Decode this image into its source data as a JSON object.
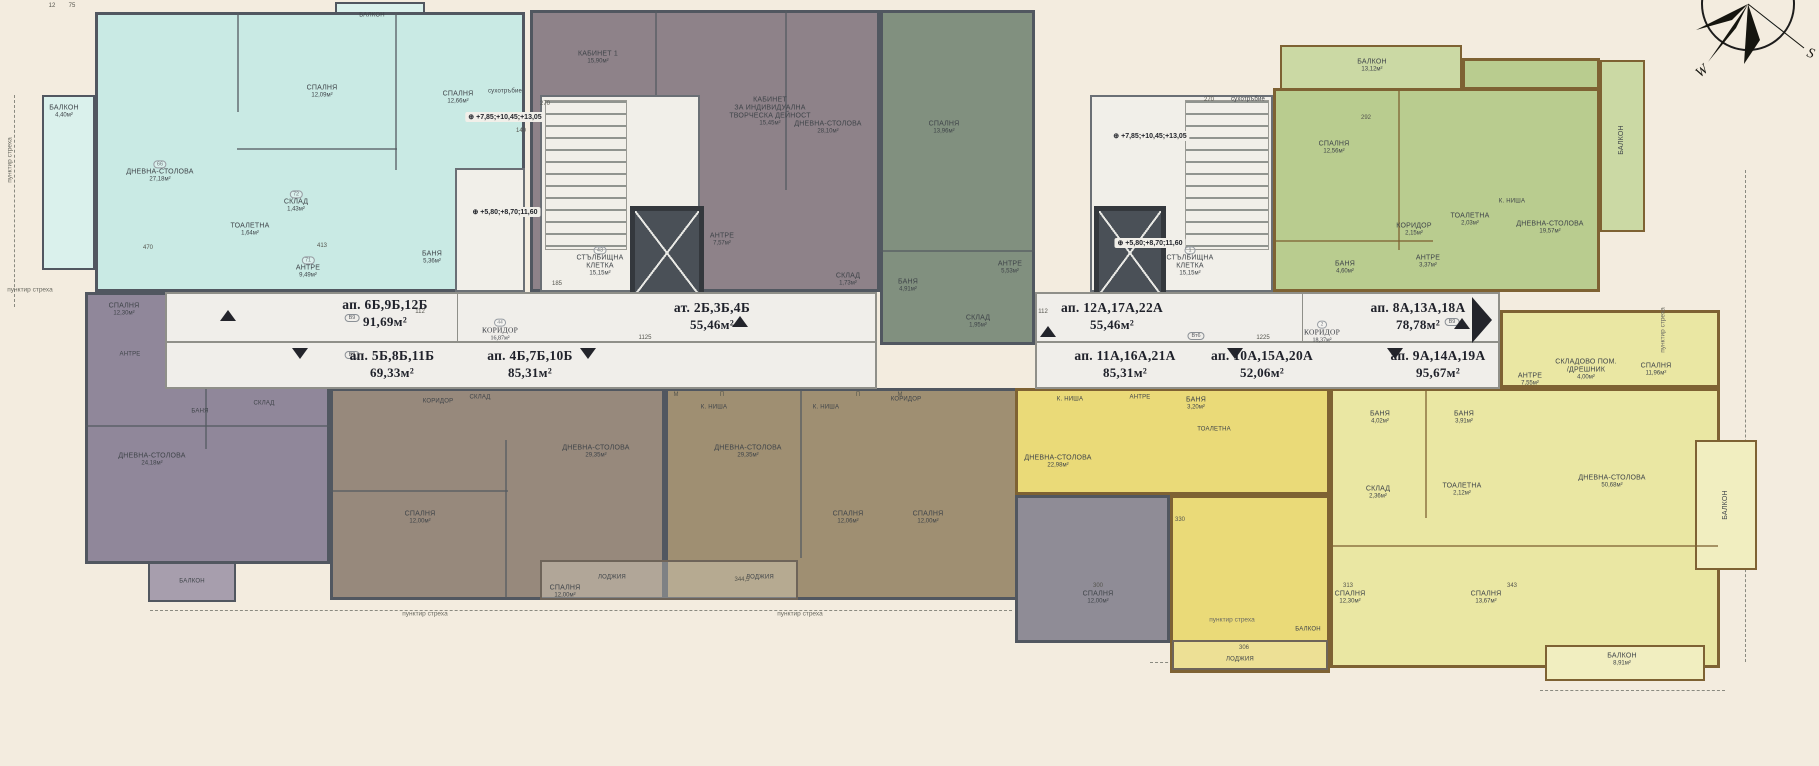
{
  "palette": {
    "background": "#f3ecdf",
    "teal": "#c9eae4",
    "purple": "#90879a",
    "mauve": "#8e8289",
    "sage": "#81907f",
    "brown_left": "#97897c",
    "brown_right": "#9f8f72",
    "gray": "#8f8c96",
    "yellow": "#eada78",
    "pale_yellow": "#eae7a3",
    "green": "#b9cc8f",
    "wall_dark": "#515760",
    "wall_warm": "#7e6233",
    "band_white": "#f0eeea",
    "compass_blue": "#3d9adf"
  },
  "units": [
    {
      "name": "ап. 6Б,9Б,12Б",
      "area": "91,69м²"
    },
    {
      "name": "ап. 5Б,8Б,11Б",
      "area": "69,33м²"
    },
    {
      "name": "ап. 4Б,7Б,10Б",
      "area": "85,31м²"
    },
    {
      "name": "ат. 2Б,3Б,4Б",
      "area": "55,46м²"
    },
    {
      "name": "ап. 12А,17А,22А",
      "area": "55,46м²"
    },
    {
      "name": "ап. 11А,16А,21А",
      "area": "85,31м²"
    },
    {
      "name": "ап. 10А,15А,20А",
      "area": "52,06м²"
    },
    {
      "name": "ап. 8А,13А,18А",
      "area": "78,78м²"
    },
    {
      "name": "ап. 9А,14А,19А",
      "area": "95,67м²"
    }
  ],
  "levels": {
    "upper": "+7,85;+10,45;+13,05",
    "lower": "+5,80;+8,70;11,60"
  },
  "compass": {
    "west": "W",
    "south": "S"
  },
  "eave": {
    "label": "пунктир стреха"
  },
  "eaves": [
    {
      "x": 30,
      "y": 290
    },
    {
      "x": 10,
      "y": 160,
      "rot": 1
    },
    {
      "x": 425,
      "y": 614
    },
    {
      "x": 800,
      "y": 614
    },
    {
      "x": 1232,
      "y": 620
    },
    {
      "x": 1663,
      "y": 330,
      "rot": 1
    }
  ],
  "rooms": [
    {
      "t": "БАЛКОН",
      "a": "4,40м²",
      "x": 64,
      "y": 112
    },
    {
      "t": "ДНЕВНА-СТОЛОВА",
      "a": "27,18м²",
      "x": 160,
      "y": 172,
      "r": "66"
    },
    {
      "t": "СПАЛНЯ",
      "a": "12,09м²",
      "x": 322,
      "y": 92
    },
    {
      "t": "СПАЛНЯ",
      "a": "12,66м²",
      "x": 458,
      "y": 98
    },
    {
      "t": "СКЛАД",
      "a": "1,43м²",
      "x": 296,
      "y": 202,
      "r": "72"
    },
    {
      "t": "ТОАЛЕТНА",
      "a": "1,64м²",
      "x": 250,
      "y": 230
    },
    {
      "t": "БАНЯ",
      "a": "5,36м²",
      "x": 432,
      "y": 258
    },
    {
      "t": "АНТРЕ",
      "a": "9,49м²",
      "x": 308,
      "y": 268,
      "r": "71"
    },
    {
      "t": "БАЛКОН",
      "x": 372,
      "y": 16,
      "c": "tiny"
    },
    {
      "t": "СПАЛНЯ",
      "a": "12,30м²",
      "x": 124,
      "y": 310
    },
    {
      "t": "АНТРЕ",
      "x": 130,
      "y": 355,
      "c": "tiny"
    },
    {
      "t": "БАНЯ",
      "x": 200,
      "y": 412,
      "c": "tiny"
    },
    {
      "t": "СКЛАД",
      "x": 264,
      "y": 404,
      "c": "tiny"
    },
    {
      "t": "ДНЕВНА-СТОЛОВА",
      "a": "24,18м²",
      "x": 152,
      "y": 460
    },
    {
      "t": "БАЛКОН",
      "x": 192,
      "y": 582,
      "c": "tiny"
    },
    {
      "t": "КАБИНЕТ 1",
      "a": "15,90м²",
      "x": 598,
      "y": 58
    },
    {
      "t": "КАБИНЕТ\nЗА ИНДИВИДУАЛНА\nТВОРЧЕСКА ДЕЙНОСТ",
      "a": "15,45м²",
      "x": 770,
      "y": 112
    },
    {
      "t": "АНТРЕ",
      "a": "7,57м²",
      "x": 722,
      "y": 240
    },
    {
      "t": "СКЛАД",
      "a": "1,73м²",
      "x": 848,
      "y": 280
    },
    {
      "t": "ДНЕВНА-СТОЛОВА",
      "a": "28,10м²",
      "x": 828,
      "y": 128
    },
    {
      "t": "СПАЛНЯ",
      "a": "13,96м²",
      "x": 944,
      "y": 128
    },
    {
      "t": "БАНЯ",
      "a": "4,91м²",
      "x": 908,
      "y": 286
    },
    {
      "t": "СКЛАД",
      "a": "1,95м²",
      "x": 978,
      "y": 322
    },
    {
      "t": "АНТРЕ",
      "a": "5,53м²",
      "x": 1010,
      "y": 268
    },
    {
      "t": "СТЪЛБИЩНА\nКЛЕТКА",
      "a": "15,15м²",
      "x": 600,
      "y": 262,
      "r": "43"
    },
    {
      "t": "СТЪЛБИЩНА\nКЛЕТКА",
      "a": "15,15м²",
      "x": 1190,
      "y": 262,
      "r": "1"
    },
    {
      "t": "сухотръбие",
      "x": 505,
      "y": 92,
      "c": "tiny"
    },
    {
      "t": "сухотръбие",
      "x": 1248,
      "y": 100,
      "c": "tiny"
    },
    {
      "t": "КОРИДОР",
      "a": "16,87м²",
      "x": 500,
      "y": 330,
      "r": "44",
      "c": "corr"
    },
    {
      "t": "КОРИДОР",
      "a": "18,37м²",
      "x": 1322,
      "y": 332,
      "r": "2",
      "c": "corr"
    },
    {
      "t": "КОРИДОР",
      "x": 438,
      "y": 402,
      "c": "tiny"
    },
    {
      "t": "СКЛАД",
      "x": 480,
      "y": 398,
      "c": "tiny"
    },
    {
      "t": "ДНЕВНА-СТОЛОВА",
      "a": "29,35м²",
      "x": 596,
      "y": 452
    },
    {
      "t": "К. НИША",
      "x": 714,
      "y": 408,
      "c": "tiny"
    },
    {
      "t": "К. НИША",
      "x": 826,
      "y": 408,
      "c": "tiny"
    },
    {
      "t": "ДНЕВНА-СТОЛОВА",
      "a": "29,35м²",
      "x": 748,
      "y": 452
    },
    {
      "t": "КОРИДОР",
      "x": 906,
      "y": 400,
      "c": "tiny"
    },
    {
      "t": "СПАЛНЯ",
      "a": "12,00м²",
      "x": 420,
      "y": 518
    },
    {
      "t": "СПАЛНЯ",
      "a": "12,00м²",
      "x": 565,
      "y": 592
    },
    {
      "t": "СПАЛНЯ",
      "a": "12,06м²",
      "x": 848,
      "y": 518
    },
    {
      "t": "СПАЛНЯ",
      "a": "12,00м²",
      "x": 928,
      "y": 518
    },
    {
      "t": "ЛОДЖИЯ",
      "x": 612,
      "y": 578,
      "c": "tiny"
    },
    {
      "t": "ЛОДЖИЯ",
      "x": 760,
      "y": 578,
      "c": "tiny"
    },
    {
      "t": "СПАЛНЯ",
      "a": "12,00м²",
      "x": 1098,
      "y": 598
    },
    {
      "t": "К. НИША",
      "x": 1070,
      "y": 400,
      "c": "tiny"
    },
    {
      "t": "АНТРЕ",
      "x": 1140,
      "y": 398,
      "c": "tiny"
    },
    {
      "t": "БАНЯ",
      "a": "3,20м²",
      "x": 1196,
      "y": 404
    },
    {
      "t": "ТОАЛЕТНА",
      "x": 1214,
      "y": 430,
      "c": "tiny"
    },
    {
      "t": "ДНЕВНА-СТОЛОВА",
      "a": "22,98м²",
      "x": 1058,
      "y": 462
    },
    {
      "t": "ЛОДЖИЯ",
      "x": 1240,
      "y": 660,
      "c": "tiny"
    },
    {
      "t": "СКЛАД",
      "a": "2,36м²",
      "x": 1378,
      "y": 493
    },
    {
      "t": "ТОАЛЕТНА",
      "a": "2,12м²",
      "x": 1462,
      "y": 490
    },
    {
      "t": "БАНЯ",
      "a": "4,02м²",
      "x": 1380,
      "y": 418
    },
    {
      "t": "БАНЯ",
      "a": "3,91м²",
      "x": 1464,
      "y": 418
    },
    {
      "t": "АНТРЕ",
      "a": "7,55м²",
      "x": 1530,
      "y": 380
    },
    {
      "t": "СКЛАДОВО ПОМ.\n/ДРЕШНИК",
      "a": "4,00м²",
      "x": 1586,
      "y": 370
    },
    {
      "t": "СПАЛНЯ",
      "a": "11,96м²",
      "x": 1656,
      "y": 370
    },
    {
      "t": "СПАЛНЯ",
      "a": "12,30м²",
      "x": 1350,
      "y": 598
    },
    {
      "t": "СПАЛНЯ",
      "a": "13,67м²",
      "x": 1486,
      "y": 598
    },
    {
      "t": "ДНЕВНА-СТОЛОВА",
      "a": "50,68м²",
      "x": 1612,
      "y": 482
    },
    {
      "t": "БАЛКОН",
      "x": 1308,
      "y": 630,
      "c": "tiny"
    },
    {
      "t": "БАЛКОН",
      "a": "8,91м²",
      "x": 1622,
      "y": 660
    },
    {
      "t": "БАЛКОН",
      "x": 1726,
      "y": 505,
      "c": "rot"
    },
    {
      "t": "СПАЛНЯ",
      "a": "12,56м²",
      "x": 1334,
      "y": 148
    },
    {
      "t": "КОРИДОР",
      "a": "2,15м²",
      "x": 1414,
      "y": 230
    },
    {
      "t": "ТОАЛЕТНА",
      "a": "2,03м²",
      "x": 1470,
      "y": 220
    },
    {
      "t": "АНТРЕ",
      "a": "3,37м²",
      "x": 1428,
      "y": 262
    },
    {
      "t": "БАНЯ",
      "a": "4,60м²",
      "x": 1345,
      "y": 268
    },
    {
      "t": "К. НИША",
      "x": 1512,
      "y": 202,
      "c": "tiny"
    },
    {
      "t": "ДНЕВНА-СТОЛОВА",
      "a": "19,57м²",
      "x": 1550,
      "y": 228
    },
    {
      "t": "БАЛКОН",
      "a": "13,12м²",
      "x": 1372,
      "y": 66
    },
    {
      "t": "БАЛКОН",
      "x": 1622,
      "y": 140,
      "c": "rot"
    }
  ],
  "badges": [
    {
      "x": 352,
      "y": 318,
      "t": "В9"
    },
    {
      "x": 352,
      "y": 355,
      "t": "В9"
    },
    {
      "x": 1452,
      "y": 322,
      "t": "В9"
    },
    {
      "x": 1196,
      "y": 336,
      "t": "Вт6"
    }
  ],
  "dims": [
    {
      "x": 52,
      "y": 6,
      "t": "12"
    },
    {
      "x": 72,
      "y": 6,
      "t": "75"
    },
    {
      "x": 545,
      "y": 104,
      "t": "270"
    },
    {
      "x": 521,
      "y": 131,
      "t": "140"
    },
    {
      "x": 645,
      "y": 338,
      "t": "1125"
    },
    {
      "x": 1263,
      "y": 338,
      "t": "1225"
    },
    {
      "x": 1043,
      "y": 312,
      "t": "112"
    },
    {
      "x": 420,
      "y": 312,
      "t": "112"
    },
    {
      "x": 148,
      "y": 248,
      "t": "470"
    },
    {
      "x": 322,
      "y": 246,
      "t": "413"
    },
    {
      "x": 557,
      "y": 284,
      "t": "185"
    },
    {
      "x": 1209,
      "y": 100,
      "t": "270"
    },
    {
      "x": 742,
      "y": 580,
      "t": "344,5"
    },
    {
      "x": 1348,
      "y": 586,
      "t": "313"
    },
    {
      "x": 1512,
      "y": 586,
      "t": "343"
    },
    {
      "x": 1244,
      "y": 648,
      "t": "306"
    },
    {
      "x": 1366,
      "y": 118,
      "t": "292"
    },
    {
      "x": 1180,
      "y": 520,
      "t": "330"
    },
    {
      "x": 1098,
      "y": 586,
      "t": "300"
    },
    {
      "x": 676,
      "y": 395,
      "t": "М"
    },
    {
      "x": 722,
      "y": 395,
      "t": "П"
    },
    {
      "x": 858,
      "y": 395,
      "t": "П"
    },
    {
      "x": 900,
      "y": 395,
      "t": "М"
    }
  ]
}
